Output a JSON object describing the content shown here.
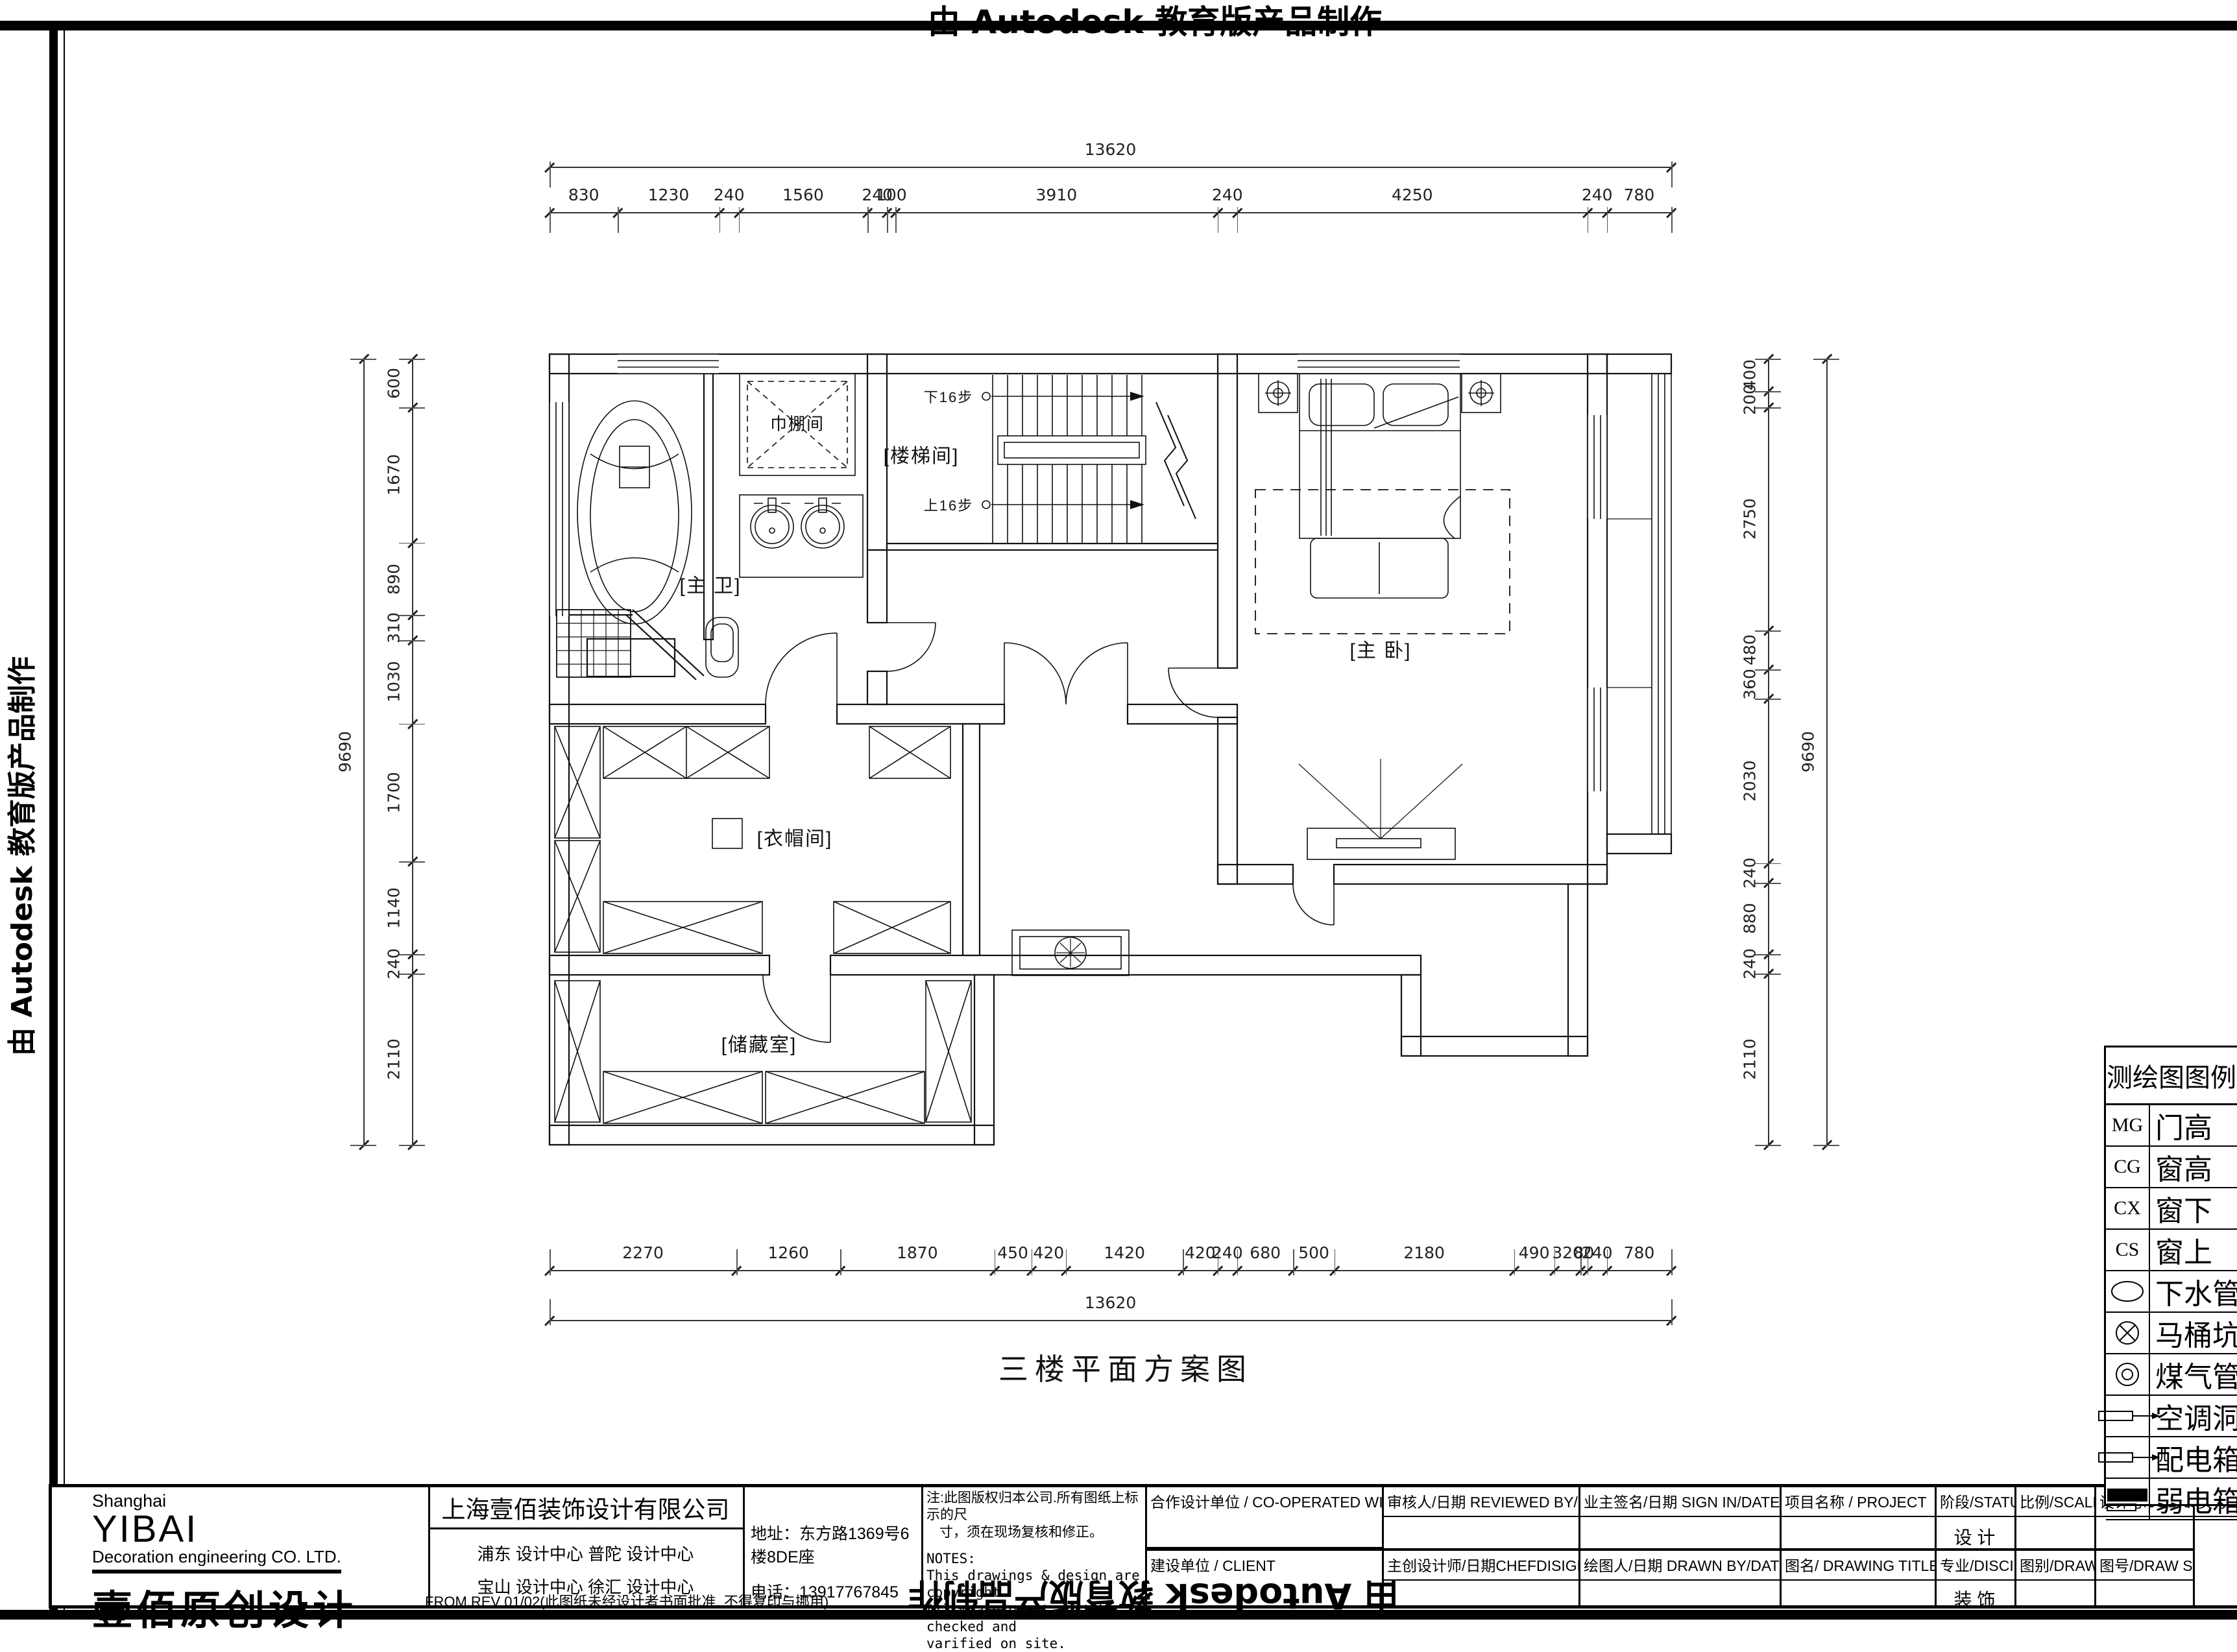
{
  "autodesk": {
    "top": "由 Autodesk 教育版产品制作",
    "left": "由 Autodesk 教育版产品制作",
    "bottom": "由 Autodesk 教育版产品制作"
  },
  "plan": {
    "title": "三楼平面方案图",
    "rooms": {
      "master_bath": "[主 卫]",
      "shower": "巾棚间",
      "stair": "[楼梯间]",
      "master_bed": "[主  卧]",
      "cloak": "[衣帽间]",
      "storage": "[储藏室]"
    },
    "stair_notes": {
      "down": "下16步",
      "up": "上16步"
    }
  },
  "dimensions": {
    "top": {
      "overall": "13620",
      "values": [
        830,
        1230,
        240,
        1560,
        240,
        100,
        3910,
        240,
        4250,
        240,
        780
      ]
    },
    "bottom": {
      "overall": "13620",
      "values": [
        2270,
        1260,
        1870,
        450,
        420,
        1420,
        420,
        240,
        680,
        500,
        2180,
        490,
        320,
        80,
        240,
        780
      ]
    },
    "left": {
      "overall": "9690",
      "values": [
        600,
        1670,
        890,
        310,
        1030,
        1700,
        1140,
        240,
        2110
      ]
    },
    "right": {
      "overall": "9690",
      "values": [
        400,
        200,
        2750,
        480,
        360,
        2030,
        240,
        880,
        240,
        2110
      ]
    }
  },
  "legend": {
    "title": "测绘图图例",
    "rows": [
      {
        "sym": "MG",
        "symtype": "text",
        "label": "门高"
      },
      {
        "sym": "CG",
        "symtype": "text",
        "label": "窗高"
      },
      {
        "sym": "CX",
        "symtype": "text",
        "label": "窗下"
      },
      {
        "sym": "CS",
        "symtype": "text",
        "label": "窗上"
      },
      {
        "sym": "ellipse",
        "symtype": "shape",
        "label": "下水管"
      },
      {
        "sym": "circle-x",
        "symtype": "shape",
        "label": "马桶坑"
      },
      {
        "sym": "circle-double",
        "symtype": "shape",
        "label": "煤气管"
      },
      {
        "sym": "arrow-rect",
        "symtype": "shape",
        "label": "空调洞"
      },
      {
        "sym": "bar-arrow",
        "symtype": "shape",
        "label": "配电箱"
      },
      {
        "sym": "bar-solid",
        "symtype": "shape",
        "label": "弱电箱"
      }
    ]
  },
  "titleblock": {
    "logo": {
      "shanghai": "Shanghai",
      "yibai": "YIBAI",
      "sub": "Decoration engineering CO. LTD.",
      "cn": "壹佰原创设计"
    },
    "company": "上海壹佰装饰设计有限公司",
    "centers_row1": "浦东 设计中心    普陀 设计中心",
    "centers_row2": "宝山 设计中心    徐汇 设计中心",
    "address": "地址：东方路1369号6楼8DE座",
    "phone": "电话：13917767845",
    "note_cn1": "注:此图版权归本公司.所有图纸上标示的尺",
    "note_cn2": "寸，须在现场复核和修正。",
    "notes_title": "NOTES:",
    "notes_line1": "This drawings & design are copyright.",
    "notes_line2": "All measurement must be checked and",
    "notes_line3": "varified on site.",
    "coop": "合作设计单位 / CO-OPERATED WITH",
    "client": "建设单位 / CLIENT",
    "reviewed": "审核人/日期   REVIEWED BY/DATE",
    "chief": "主创设计师/日期CHEFDISIGNER/DATE",
    "sign": "业主签名/日期  SIGN IN/DATE",
    "drawn": "绘图人/日期  DRAWN BY/DATE",
    "project": "项目名称 / PROJECT",
    "drawing_title": "图名/  DRAWING TITLE",
    "status_label": "阶段/STATUS",
    "status_value": "设  计",
    "discipline_label": "专业/DISCIPLINE",
    "discipline_value": "装  饰",
    "scale_label": "比例/SCALE",
    "drawtype_label": "图别/DRAW TYPE",
    "jobno_label": "设计号/JOBNO.",
    "drawsn_label": "图号/DRAW SN",
    "page_label": "页号/PAGE N",
    "footnote": "FROM.REV 01/02(此图纸未经设计者书面批准, 不得复印与挪用)"
  }
}
